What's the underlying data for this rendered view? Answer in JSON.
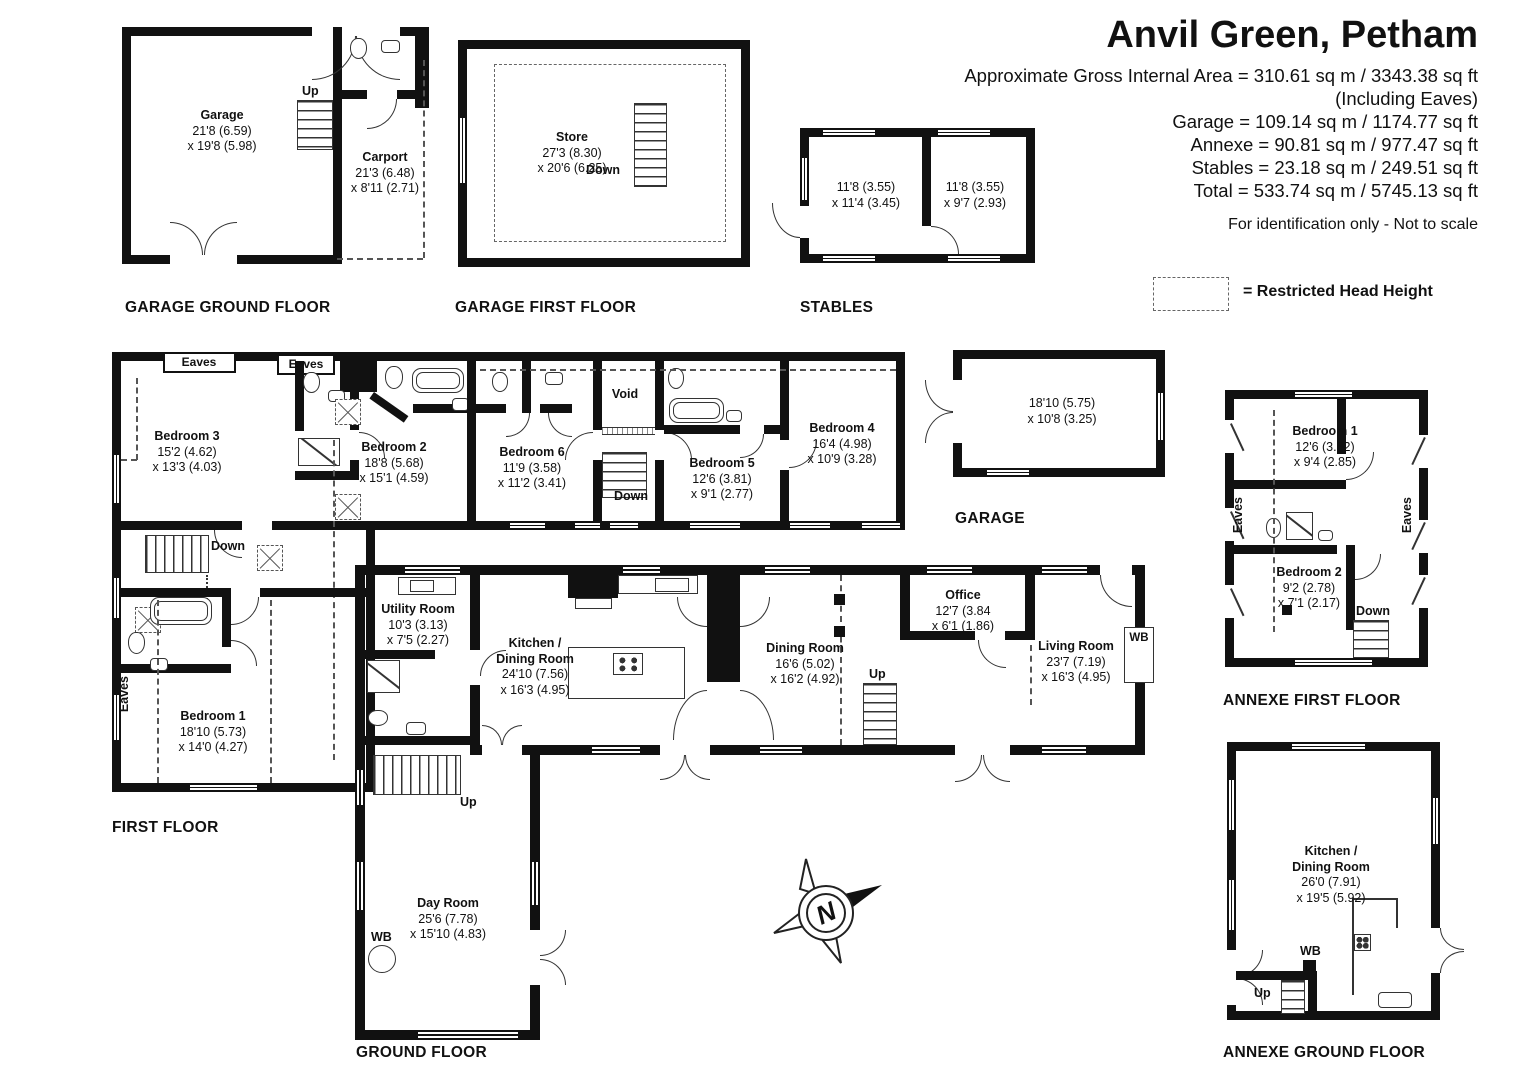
{
  "title": "Anvil Green, Petham",
  "area_summary": {
    "gross": "Approximate Gross Internal Area = 310.61 sq m / 3343.38 sq ft",
    "including": "(Including Eaves)",
    "garage": "Garage = 109.14 sq m / 1174.77 sq ft",
    "annexe": "Annexe = 90.81 sq m / 977.47 sq ft",
    "stables": "Stables = 23.18 sq m / 249.51 sq ft",
    "total": "Total = 533.74 sq m / 5745.13 sq ft",
    "disclaimer": "For identification only - Not to scale"
  },
  "legend": {
    "restricted_head_height": "= Restricted Head Height"
  },
  "floor_labels": {
    "garage_ground": "GARAGE GROUND FLOOR",
    "garage_first": "GARAGE FIRST FLOOR",
    "stables": "STABLES",
    "first": "FIRST FLOOR",
    "garage_out": "GARAGE",
    "annexe_first": "ANNEXE FIRST FLOOR",
    "ground": "GROUND FLOOR",
    "annexe_ground": "ANNEXE GROUND FLOOR"
  },
  "rooms": {
    "garage_gf": {
      "name": "Garage",
      "d1": "21'8 (6.59)",
      "d2": "x 19'8 (5.98)"
    },
    "carport": {
      "name": "Carport",
      "d1": "21'3 (6.48)",
      "d2": "x 8'11 (2.71)"
    },
    "store": {
      "name": "Store",
      "d1": "27'3 (8.30)",
      "d2": "x 20'6 (6.25)"
    },
    "stable_left": {
      "d1": "11'8 (3.55)",
      "d2": "x 11'4 (3.45)"
    },
    "stable_right": {
      "d1": "11'8 (3.55)",
      "d2": "x 9'7 (2.93)"
    },
    "bedroom3": {
      "name": "Bedroom 3",
      "d1": "15'2 (4.62)",
      "d2": "x 13'3 (4.03)"
    },
    "bedroom2": {
      "name": "Bedroom 2",
      "d1": "18'8 (5.68)",
      "d2": "x 15'1 (4.59)"
    },
    "bedroom6": {
      "name": "Bedroom 6",
      "d1": "11'9 (3.58)",
      "d2": "x 11'2 (3.41)"
    },
    "bedroom5": {
      "name": "Bedroom 5",
      "d1": "12'6 (3.81)",
      "d2": "x 9'1 (2.77)"
    },
    "bedroom4": {
      "name": "Bedroom 4",
      "d1": "16'4 (4.98)",
      "d2": "x 10'9 (3.28)"
    },
    "bedroom1_first": {
      "name": "Bedroom 1",
      "d1": "18'10 (5.73)",
      "d2": "x 14'0 (4.27)"
    },
    "garage_out": {
      "d1": "18'10 (5.75)",
      "d2": "x 10'8 (3.25)"
    },
    "annexe_bed1": {
      "name": "Bedroom 1",
      "d1": "12'6 (3.82)",
      "d2": "x 9'4 (2.85)"
    },
    "annexe_bed2": {
      "name": "Bedroom 2",
      "d1": "9'2 (2.78)",
      "d2": "x 7'1 (2.17)"
    },
    "utility": {
      "name": "Utility Room",
      "d1": "10'3 (3.13)",
      "d2": "x 7'5 (2.27)"
    },
    "kitchen_main": {
      "name1": "Kitchen /",
      "name2": "Dining Room",
      "d1": "24'10 (7.56)",
      "d2": "x 16'3 (4.95)"
    },
    "dining": {
      "name": "Dining Room",
      "d1": "16'6 (5.02)",
      "d2": "x 16'2 (4.92)"
    },
    "office": {
      "name": "Office",
      "d1": "12'7 (3.84",
      "d2": "x 6'1 (1.86)"
    },
    "living": {
      "name": "Living Room",
      "d1": "23'7 (7.19)",
      "d2": "x 16'3 (4.95)"
    },
    "day_room": {
      "name": "Day Room",
      "d1": "25'6 (7.78)",
      "d2": "x 15'10 (4.83)"
    },
    "annexe_kitchen": {
      "name1": "Kitchen /",
      "name2": "Dining Room",
      "d1": "26'0 (7.91)",
      "d2": "x 19'5 (5.92)"
    }
  },
  "annotations": {
    "up": "Up",
    "down": "Down",
    "void": "Void",
    "eaves": "Eaves",
    "wb": "WB",
    "north": "N"
  }
}
